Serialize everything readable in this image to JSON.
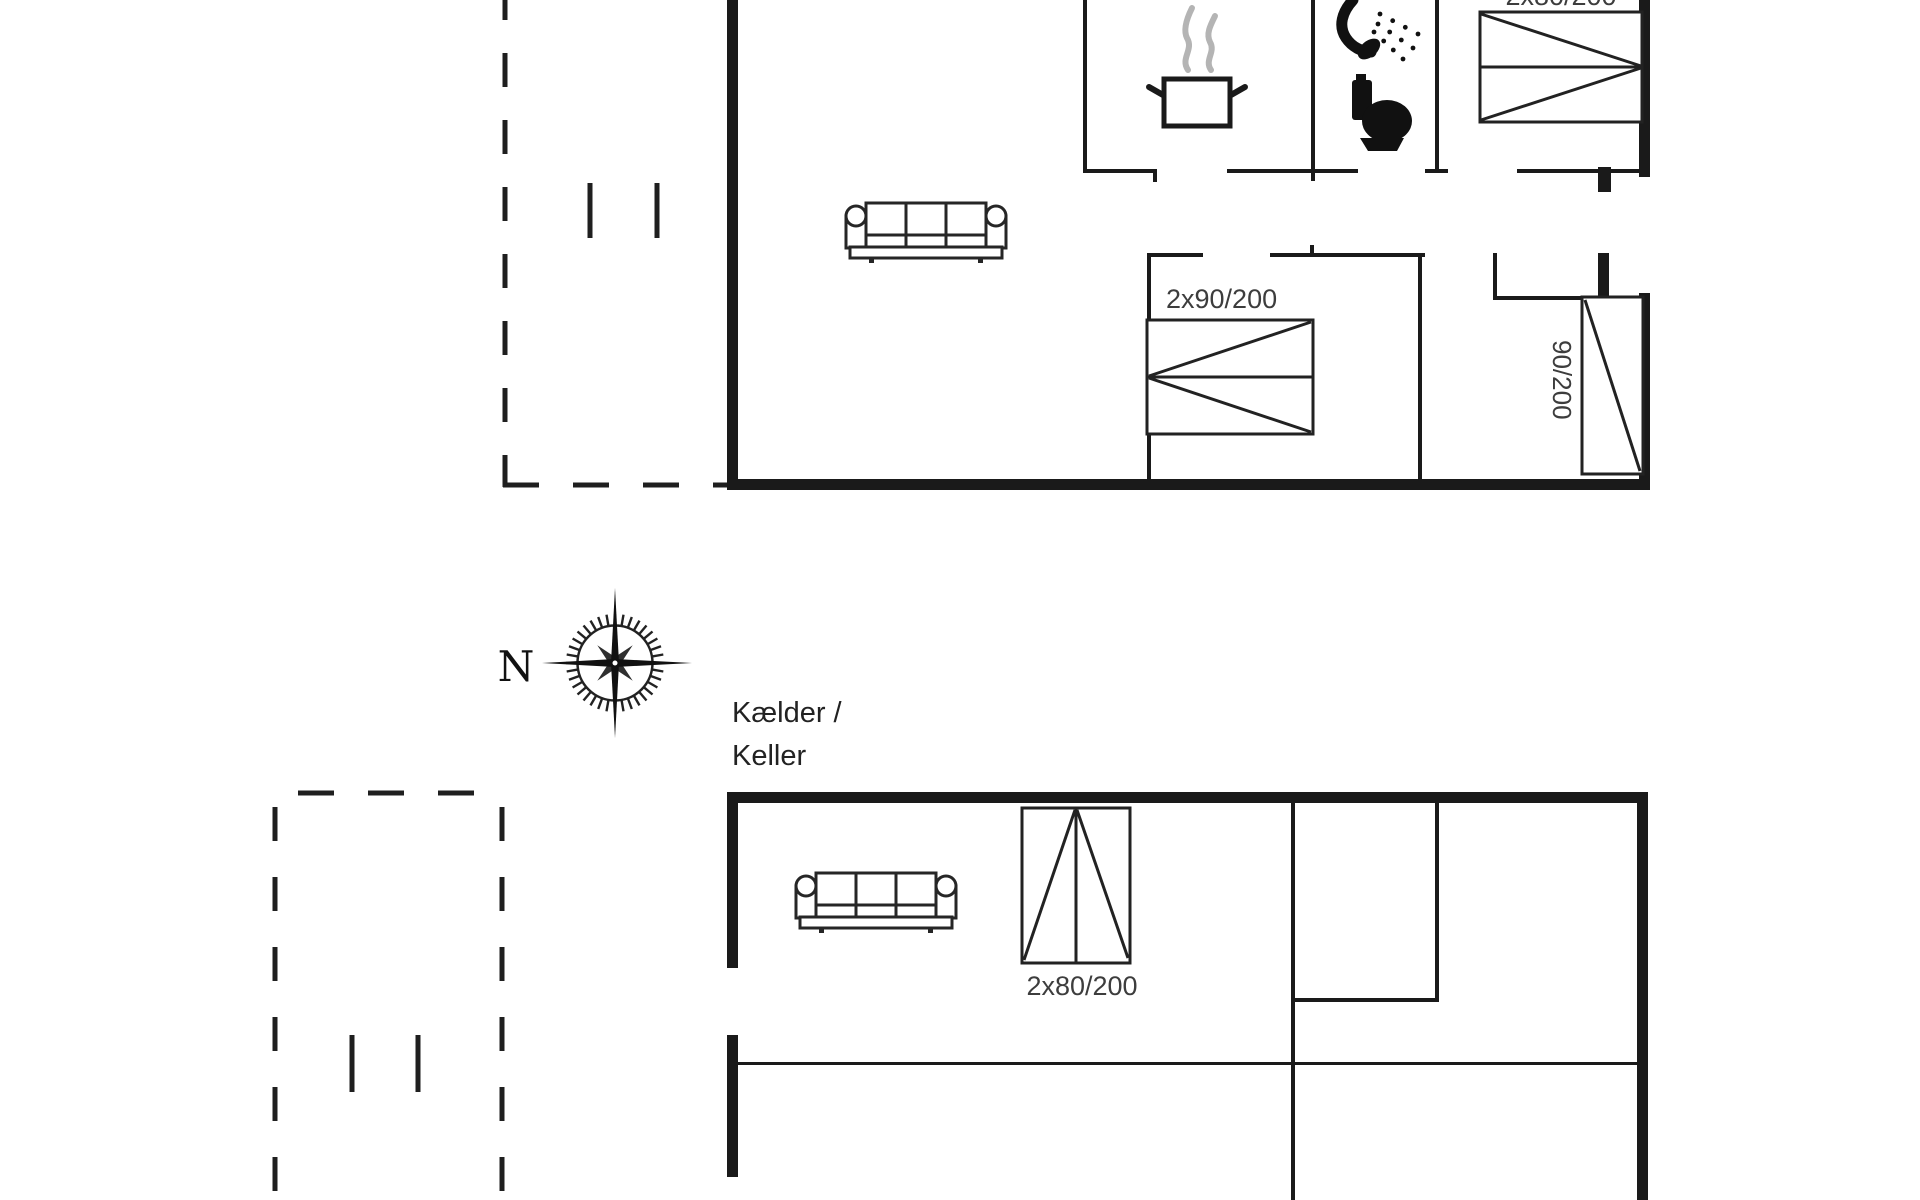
{
  "colors": {
    "background": "#ffffff",
    "wall": "#1a1a1a",
    "furniture_line": "#262626",
    "label": "#3d3d3d",
    "steam": "#b4b4b4"
  },
  "upper_floor": {
    "bed_top_right_label": "2x80/200",
    "bed_double_label": "2x90/200",
    "bed_single_label": "90/200"
  },
  "basement": {
    "title_line1": "Kælder /",
    "title_line2": "Keller",
    "bed_label": "2x80/200"
  },
  "compass": {
    "north_label": "N"
  },
  "icons": [
    "cooking-pot-icon",
    "steam-icon",
    "shower-icon",
    "toilet-icon",
    "sofa-symbol",
    "compass-rose-icon"
  ]
}
